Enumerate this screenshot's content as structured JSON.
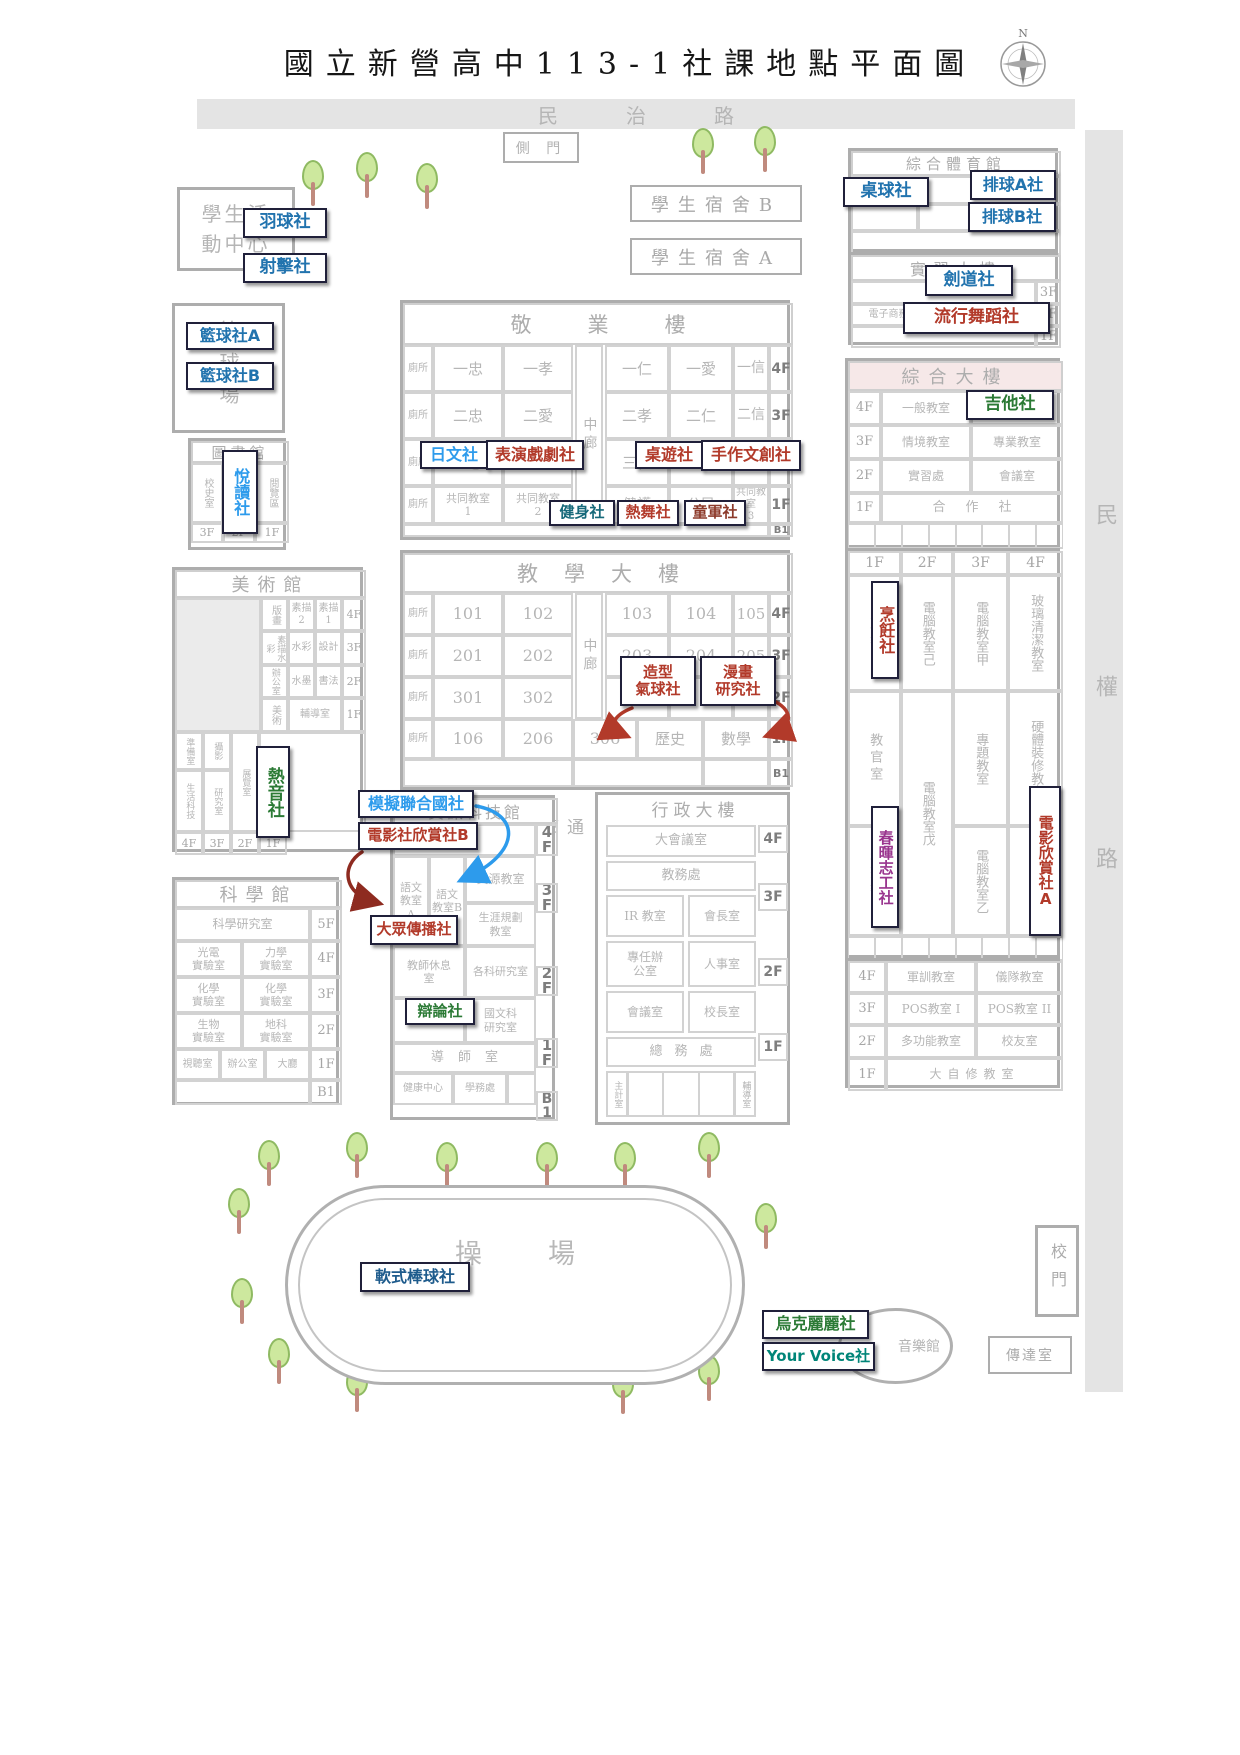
{
  "title": "國立新營高中113-1社課地點平面圖",
  "compass": {
    "n": "N"
  },
  "roads": {
    "top": "民治路",
    "right": "民權路"
  },
  "gates": {
    "side": "側 門",
    "main": "校門",
    "reception": "傳達室"
  },
  "dorms": {
    "b": "學生宿舍B",
    "a": "學生宿舍A"
  },
  "places": {
    "student_center": "學生活動中心",
    "basketball_court": "籃球場",
    "playground": "操場",
    "music_hall": "音樂館",
    "corridor": "通廊"
  },
  "clubs": {
    "badminton": "羽球社",
    "shooting": "射擊社",
    "basketball_a": "籃球社A",
    "basketball_b": "籃球社B",
    "table_tennis": "桌球社",
    "volleyball_a": "排球A社",
    "volleyball_b": "排球B社",
    "kendo": "劍道社",
    "street_dance": "流行舞蹈社",
    "reading": "悅讀社",
    "japanese": "日文社",
    "drama": "表演戲劇社",
    "board_game": "桌遊社",
    "handcraft": "手作文創社",
    "fitness": "健身社",
    "dance": "熱舞社",
    "scouts": "童軍社",
    "guitar": "吉他社",
    "cooking": "烹飪社",
    "chunhui": "春暉志工社",
    "film_a": "電影欣賞社A",
    "rock_music": "熱音社",
    "balloon": "造型\n氣球社",
    "manga": "漫畫\n研究社",
    "mun": "模擬聯合國社",
    "film_b": "電影社欣賞社B",
    "mass_comm": "大眾傳播社",
    "debate": "辯論社",
    "softball": "軟式棒球社",
    "ukulele": "烏克麗麗社",
    "your_voice": "Your Voice社"
  },
  "buildings": {
    "gym": {
      "title": "綜合體育館",
      "office": "辦公室",
      "court": "籃球場"
    },
    "practice": {
      "title": "實習大樓",
      "rooms": [
        "電子商務教室",
        "流通管理教室"
      ],
      "floors": [
        "3F",
        "2F",
        "1F"
      ]
    },
    "complex": {
      "title": "綜合大樓",
      "upper": {
        "floors": [
          "4F",
          "3F",
          "2F",
          "1F"
        ],
        "rows": [
          [
            "一般教室",
            ""
          ],
          [
            "情境教室",
            "專業教室"
          ],
          [
            "實習處",
            "會議室"
          ],
          [
            "合作社"
          ]
        ]
      },
      "mid": {
        "floors": [
          "1F",
          "2F",
          "3F",
          "4F"
        ],
        "col1": [
          "家政教室",
          "教官室",
          "視聽教室"
        ],
        "col2": [
          "電腦教室己",
          "電腦教室戊"
        ],
        "col3": [
          "電腦教室甲",
          "專題教室",
          "電腦教室乙"
        ],
        "col4": [
          "玻璃清潔教室",
          "硬體裝修教室",
          "實習教室"
        ]
      },
      "lower": {
        "floors": [
          "4F",
          "3F",
          "2F",
          "1F"
        ],
        "rows": [
          [
            "軍訓教室",
            "儀隊教室"
          ],
          [
            "POS教室 I",
            "POS教室 II"
          ],
          [
            "多功能教室",
            "校友室"
          ],
          [
            "大自修教室"
          ]
        ]
      }
    },
    "jingye": {
      "title": "敬業樓",
      "corridor": "中廊",
      "floors": [
        "4F",
        "3F",
        "2F",
        "1F",
        "B1"
      ],
      "rows": [
        [
          "廁所",
          "一忠",
          "一孝",
          "一仁",
          "一愛",
          "一信"
        ],
        [
          "廁所",
          "二忠",
          "二愛",
          "二孝",
          "二仁",
          "二信"
        ],
        [
          "廁所",
          "三忠",
          "三孝",
          "三仁",
          "三愛",
          "三信"
        ],
        [
          "廁所",
          "共同教室\n1",
          "共同教室\n2",
          "健護",
          "公民",
          "共同教室\n3"
        ]
      ]
    },
    "teaching": {
      "title": "教學大樓",
      "corridor": "中廊",
      "floors": [
        "4F",
        "3F",
        "2F",
        "1F",
        "B1"
      ],
      "rows": [
        [
          "廁所",
          "101",
          "102",
          "103",
          "104",
          "105"
        ],
        [
          "廁所",
          "201",
          "202",
          "203",
          "204",
          "205"
        ],
        [
          "廁所",
          "301",
          "302",
          "303"
        ],
        [
          "廁所",
          "106",
          "206",
          "306",
          "歷史",
          "數學"
        ]
      ]
    },
    "library": {
      "title": "圖書館",
      "cells": [
        "校史室",
        "閱覽區"
      ],
      "floors": [
        "3F",
        "2F",
        "1F"
      ]
    },
    "art": {
      "title": "美術館",
      "rows": [
        [
          "版畫",
          "素描2",
          "素描1"
        ],
        [
          "素描水彩",
          "水彩",
          "設計"
        ],
        [
          "辦公室",
          "水墨",
          "書法"
        ],
        [
          "美術",
          "輔導室"
        ]
      ],
      "floors": [
        "4F",
        "3F",
        "2F",
        "1F"
      ],
      "annex": {
        "cells": [
          "準備室",
          "攝影",
          "展覽室",
          "生活科技",
          "研究室"
        ],
        "floors": [
          "4F",
          "3F",
          "2F",
          "1F"
        ]
      }
    },
    "science": {
      "title": "科學館",
      "floors": [
        "5F",
        "4F",
        "3F",
        "2F",
        "1F",
        "B1"
      ],
      "rows": [
        [
          "科學研究室"
        ],
        [
          "光電\n實驗室",
          "力學\n實驗室"
        ],
        [
          "化學\n實驗室",
          "化學\n實驗室"
        ],
        [
          "生物\n實驗室",
          "地科\n實驗室"
        ],
        [
          "視聽室",
          "辦公室",
          "大廳"
        ]
      ]
    },
    "infotech": {
      "title": "資訊科技館",
      "floors": [
        "4F",
        "3F",
        "2F",
        "1F",
        "B1"
      ],
      "rooms": {
        "lang_a": "語文\n教室\nA",
        "lang_b": "語文\n教室B",
        "resource": "資源教室",
        "career": "生涯規劃\n教室",
        "lounge": "教師休息\n室",
        "research": "各科研究室",
        "chinese": "國文科\n研究室",
        "homeroom": "導師室",
        "health": "健康中心",
        "affairs": "學務處"
      }
    },
    "admin": {
      "title": "行政大樓",
      "floors": [
        "4F",
        "3F",
        "2F",
        "1F"
      ],
      "rooms": {
        "meeting": "大會議室",
        "academic": "教務處",
        "ir": "IR 教室",
        "chair": "會長室",
        "dedicated": "專任辦\n公室",
        "hr": "人事室",
        "conference": "會議室",
        "principal": "校長室",
        "general": "總務處",
        "acct": "主計室",
        "counsel": "輔導室"
      }
    }
  }
}
